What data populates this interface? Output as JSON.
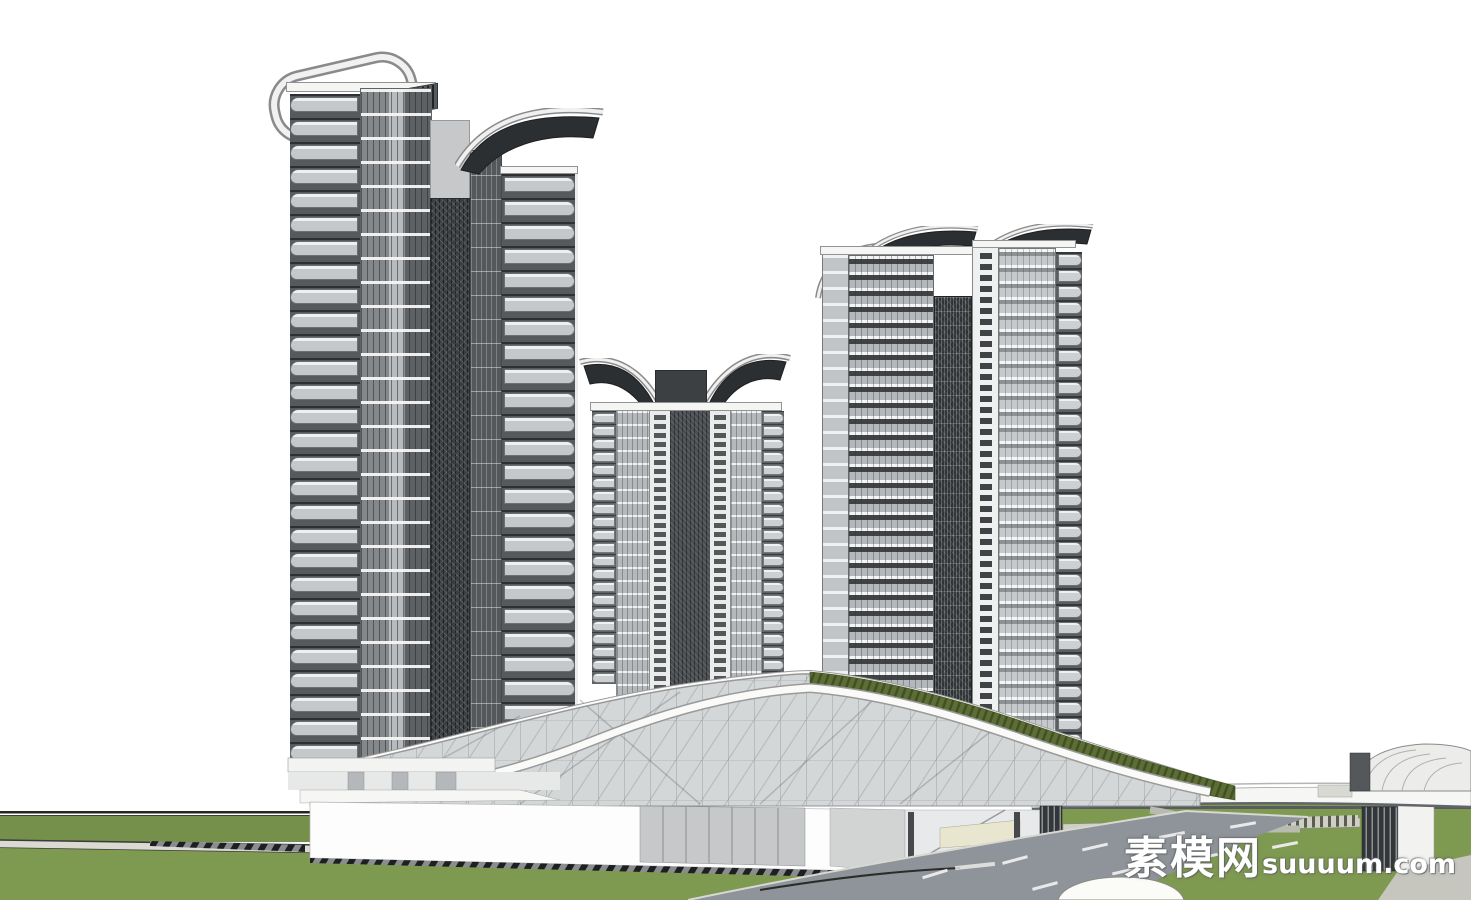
{
  "watermark": {
    "cjk": "素模网",
    "latin": "suuuum.com"
  },
  "colors": {
    "bg": "#ffffff",
    "slab": "#f2f3f3",
    "glass_dark": "#4b4f52",
    "glass_mid": "#9da1a4",
    "glass_light": "#c7cacc",
    "core_dark": "#2f3335",
    "wing_dark": "#2c2f31",
    "panel_gray": "#c6c8ca",
    "white_band": "#fafafa",
    "green_roof": "#5c6d38",
    "green_roof_dark": "#42511f",
    "grass": "#7e9950",
    "grass_upper": "#74904a",
    "road": "#8e9499",
    "road_mark": "#e9e9e9",
    "sidewalk": "#dadad2",
    "curb": "#2c2c2c"
  },
  "repeats": {
    "left_front_rows": 28,
    "left_rear_rows": 25,
    "mid_left_rows": 21,
    "mid_right_rows": 21,
    "right_b_rows": 32
  }
}
